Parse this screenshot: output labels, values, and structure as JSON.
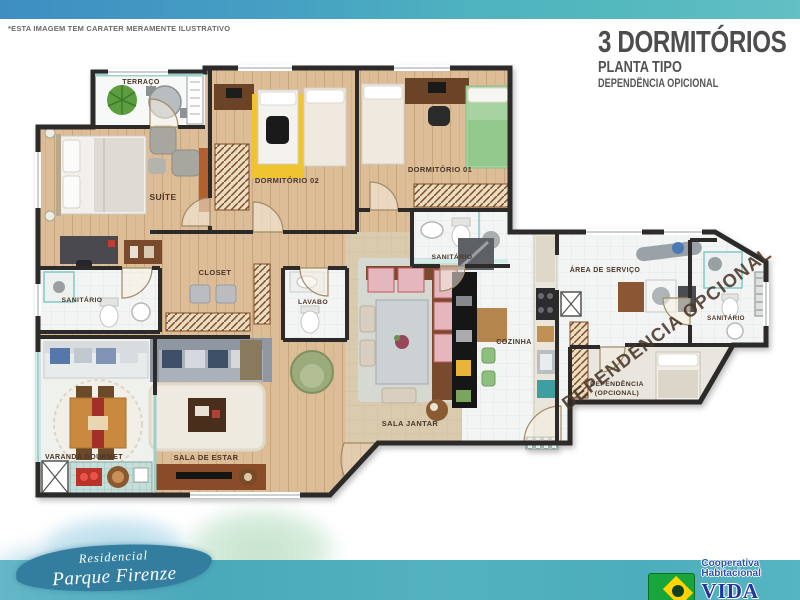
{
  "header": {
    "disclaimer": "*ESTA IMAGEM TEM CARATER MERAMENTE ILUSTRATIVO",
    "title": "3 DORMITÓRIOS",
    "subtitle": "PLANTA TIPO",
    "option_note": "DEPENDÊNCIA OPICIONAL"
  },
  "floorplan": {
    "watermark": "DEPENDÊNCIA OPCIONAL",
    "dependencia_line2": "(OPCIONAL)",
    "rooms": [
      {
        "id": "terraco",
        "label": "TERRAÇO"
      },
      {
        "id": "suite",
        "label": "SUÍTE"
      },
      {
        "id": "dormitorio-02",
        "label": "DORMITÓRIO 02"
      },
      {
        "id": "dormitorio-01",
        "label": "DORMITÓRIO 01"
      },
      {
        "id": "sanitario-suite",
        "label": "SANITÁRIO"
      },
      {
        "id": "closet",
        "label": "CLOSET"
      },
      {
        "id": "lavabo",
        "label": "LAVABO"
      },
      {
        "id": "sanitario-social",
        "label": "SANITÁRIO"
      },
      {
        "id": "area-de-servico",
        "label": "ÁREA DE SERVIÇO"
      },
      {
        "id": "sanitario-dependencia",
        "label": "SANITÁRIO"
      },
      {
        "id": "dependencia",
        "label": "DEPENDÊNCIA"
      },
      {
        "id": "cozinha",
        "label": "COZINHA"
      },
      {
        "id": "sala-jantar",
        "label": "SALA JANTAR"
      },
      {
        "id": "sala-de-estar",
        "label": "SALA DE ESTAR"
      },
      {
        "id": "varanda-gourmet",
        "label": "VARANDA GOURMET"
      }
    ]
  },
  "footer": {
    "brand_line1": "Residencial",
    "brand_line2": "Parque Firenze",
    "coop_tagline": "Cooperativa Habitacional",
    "coop_name": "VIDA NOVA"
  },
  "colors": {
    "band_blue": "#3e8ec2",
    "band_teal": "#4fb3bf",
    "wall": "#2d2b29",
    "wood_floor": "#dcbd97",
    "tile_floor": "#f3f5f4",
    "accent_teal": "#8fd0cb",
    "brand_blue": "#20369c",
    "flag_green": "#18a53c",
    "flag_yellow": "#ffd400"
  }
}
